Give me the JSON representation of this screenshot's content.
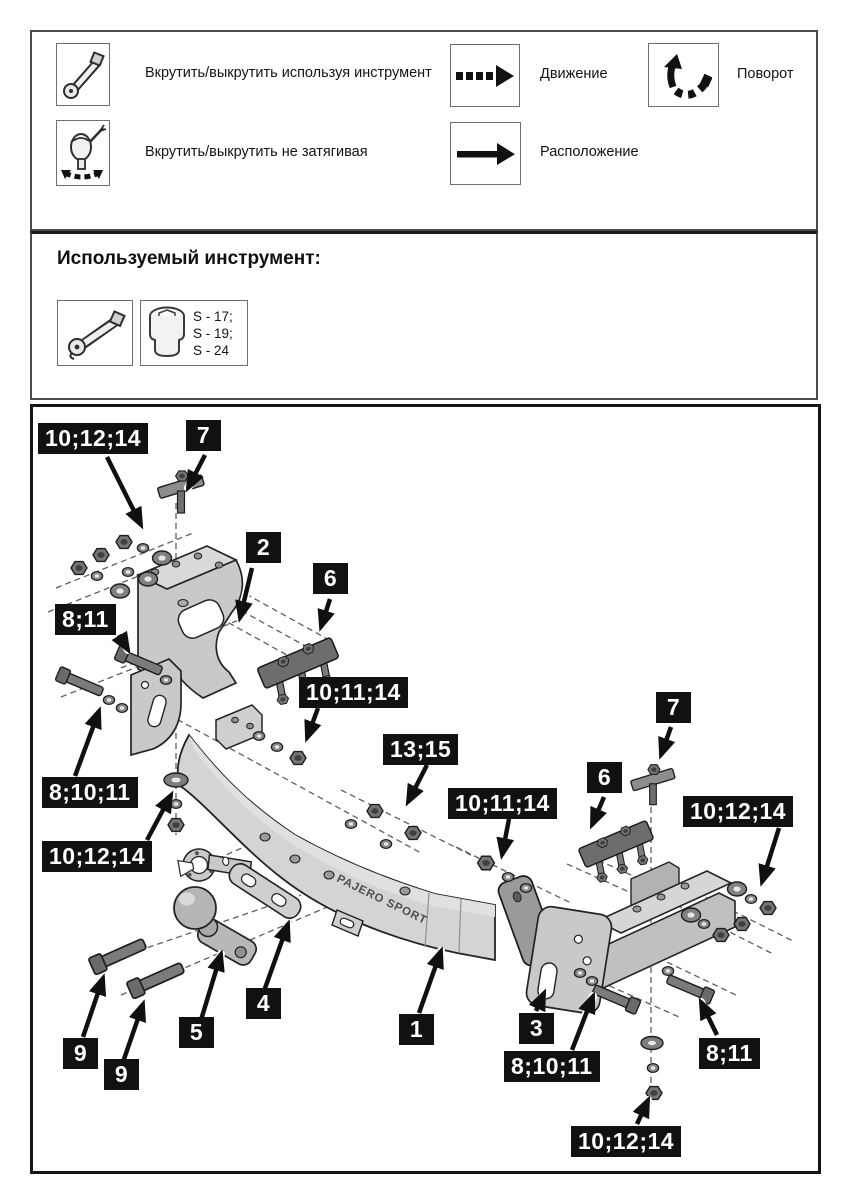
{
  "legend": {
    "items": [
      {
        "icon": "ratchet-wrench-icon",
        "label": "Вкрутить/выкрутить используя инструмент"
      },
      {
        "icon": "hand-tighten-icon",
        "label": "Вкрутить/выкрутить не затягивая"
      },
      {
        "icon": "dashed-arrow-icon",
        "label": "Движение"
      },
      {
        "icon": "solid-arrow-icon",
        "label": "Расположение"
      },
      {
        "icon": "rotate-arrow-icon",
        "label": "Поворот"
      }
    ]
  },
  "tools": {
    "heading": "Используемый инструмент:",
    "socket_sizes": [
      "S - 17;",
      "S - 19;",
      "S - 24"
    ]
  },
  "diagram": {
    "beam_text": "PAJERO SPORT",
    "callouts": [
      {
        "text": "10;12;14"
      },
      {
        "text": "7"
      },
      {
        "text": "2"
      },
      {
        "text": "6"
      },
      {
        "text": "8;11"
      },
      {
        "text": "10;11;14"
      },
      {
        "text": "13;15"
      },
      {
        "text": "8;10;11"
      },
      {
        "text": "10;12;14"
      },
      {
        "text": "7"
      },
      {
        "text": "6"
      },
      {
        "text": "10;11;14"
      },
      {
        "text": "10;12;14"
      },
      {
        "text": "9"
      },
      {
        "text": "9"
      },
      {
        "text": "5"
      },
      {
        "text": "4"
      },
      {
        "text": "1"
      },
      {
        "text": "3"
      },
      {
        "text": "8;10;11"
      },
      {
        "text": "8;11"
      },
      {
        "text": "10;12;14"
      }
    ]
  },
  "colors": {
    "callout_bg": "#111111",
    "callout_text": "#ffffff",
    "part_light": "#c9c9c9",
    "part_mid": "#9a9a9a",
    "part_dark": "#6d6d6d",
    "outline": "#232323"
  }
}
